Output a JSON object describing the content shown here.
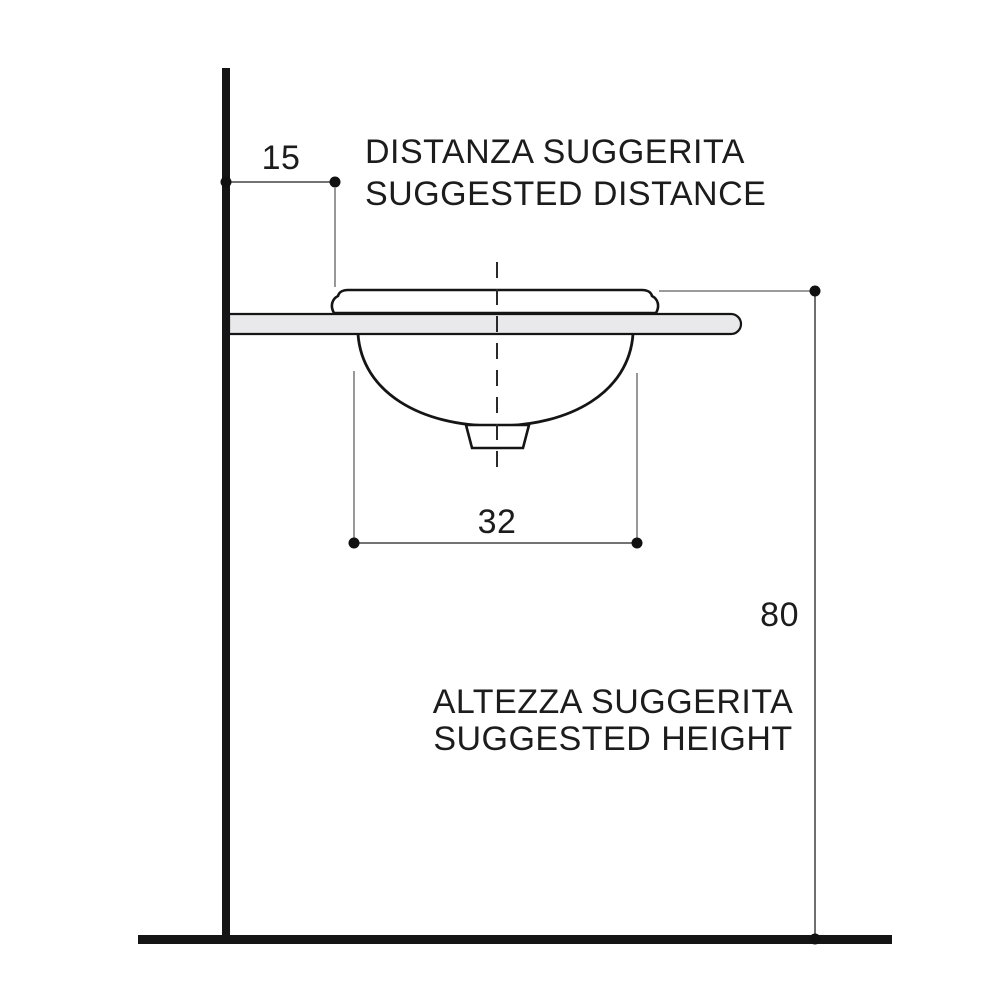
{
  "diagram": {
    "type": "washbasin-installation-side-view",
    "distance_dim": {
      "value": "15",
      "note_line1": "DISTANZA SUGGERITA",
      "note_line2": "SUGGESTED DISTANCE"
    },
    "width_dim": {
      "value": "32"
    },
    "height_dim": {
      "value": "80",
      "note_line1": "ALTEZZA SUGGERITA",
      "note_line2": "SUGGESTED HEIGHT"
    }
  },
  "colors": {
    "background": "#ffffff",
    "outline": "#151515",
    "counter_fill": "#e9e9ec",
    "dim_line": "#5f5f5f",
    "ext_line": "#8d8d8d",
    "dot": "#111111",
    "text": "#1c1c1c"
  }
}
